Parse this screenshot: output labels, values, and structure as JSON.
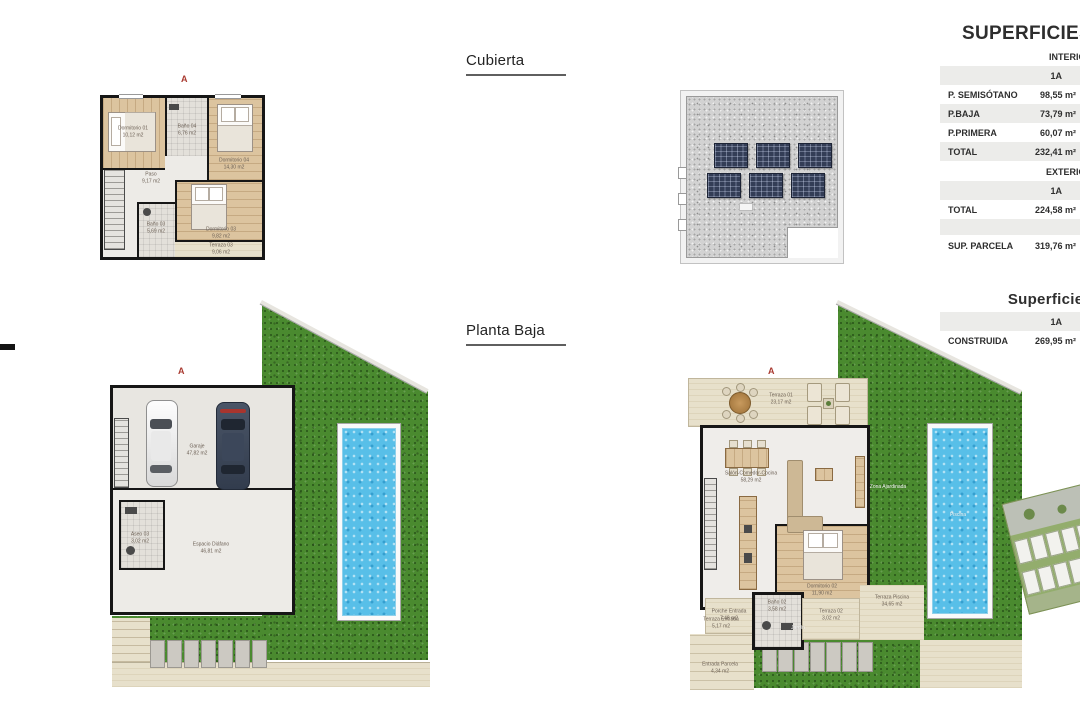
{
  "sheet": {
    "marker": "A"
  },
  "titles": {
    "roof": "Cubierta",
    "ground": "Planta Baja"
  },
  "surface_table": {
    "title": "SUPERFICIES",
    "interior": {
      "header": "INTERIOR",
      "variant": "1A",
      "rows": [
        {
          "label": "P. SEMISÓTANO",
          "value": "98,55 m²"
        },
        {
          "label": "P.BAJA",
          "value": "73,79 m²"
        },
        {
          "label": "P.PRIMERA",
          "value": "60,07 m²"
        },
        {
          "label": "TOTAL",
          "value": "232,41 m²"
        }
      ]
    },
    "exterior": {
      "header": "EXTERIOR",
      "variant": "1A",
      "rows": [
        {
          "label": "TOTAL",
          "value": "224,58 m²"
        }
      ]
    },
    "parcel": {
      "label": "SUP. PARCELA",
      "value": "319,76 m²"
    }
  },
  "built_table": {
    "title": "Superficies",
    "variant": "1A",
    "rows": [
      {
        "label": "CONSTRUIDA",
        "value": "269,95 m²"
      }
    ]
  },
  "first_floor": {
    "rooms": {
      "dormitorio_01": {
        "name": "Dormitorio 01",
        "area": "10,12 m2"
      },
      "bano_04": {
        "name": "Baño 04",
        "area": "6,76 m2"
      },
      "dormitorio_04": {
        "name": "Dormitorio 04",
        "area": "14,30 m2"
      },
      "paso": {
        "name": "Paso",
        "area": "9,17 m2"
      },
      "bano_03": {
        "name": "Baño 03",
        "area": "5,69 m2"
      },
      "dormitorio_03": {
        "name": "Dormitorio 03",
        "area": "9,82 m2"
      },
      "terraza_03": {
        "name": "Terraza 03",
        "area": "9,06 m2"
      }
    }
  },
  "basement": {
    "rooms": {
      "garaje": {
        "name": "Garaje",
        "area": "47,82 m2"
      },
      "espacio_diafano": {
        "name": "Espacio Diáfano",
        "area": "46,81 m2"
      },
      "aseo_03": {
        "name": "Aseo 03",
        "area": "3,02 m2"
      }
    }
  },
  "ground_floor": {
    "rooms": {
      "terraza_01": {
        "name": "Terraza 01",
        "area": "23,17 m2"
      },
      "salon_comedor_cocina": {
        "name": "Salón-Comedor-Cocina",
        "area": "58,29 m2"
      },
      "dormitorio_02": {
        "name": "Dormitorio 02",
        "area": "11,90 m2"
      },
      "bano_02": {
        "name": "Baño 02",
        "area": "3,58 m2"
      },
      "porche_entrada": {
        "name": "Porche Entrada",
        "area": "7,48 m2"
      },
      "terraza_02": {
        "name": "Terraza 02",
        "area": "3,02 m2"
      },
      "terraza_piscina": {
        "name": "Terraza Piscina",
        "area": "34,65 m2"
      },
      "terraza_entrada": {
        "name": "Terraza Entrada",
        "area": "5,17 m2"
      },
      "entrada_parcela": {
        "name": "Entrada Parcela",
        "area": "4,34 m2"
      },
      "jardin": {
        "name": "Jardín",
        "area": ""
      },
      "zona_ajardinada": {
        "name": "Zona Ajardinada",
        "area": ""
      },
      "piscina": {
        "name": "Piscina",
        "area": ""
      }
    }
  }
}
